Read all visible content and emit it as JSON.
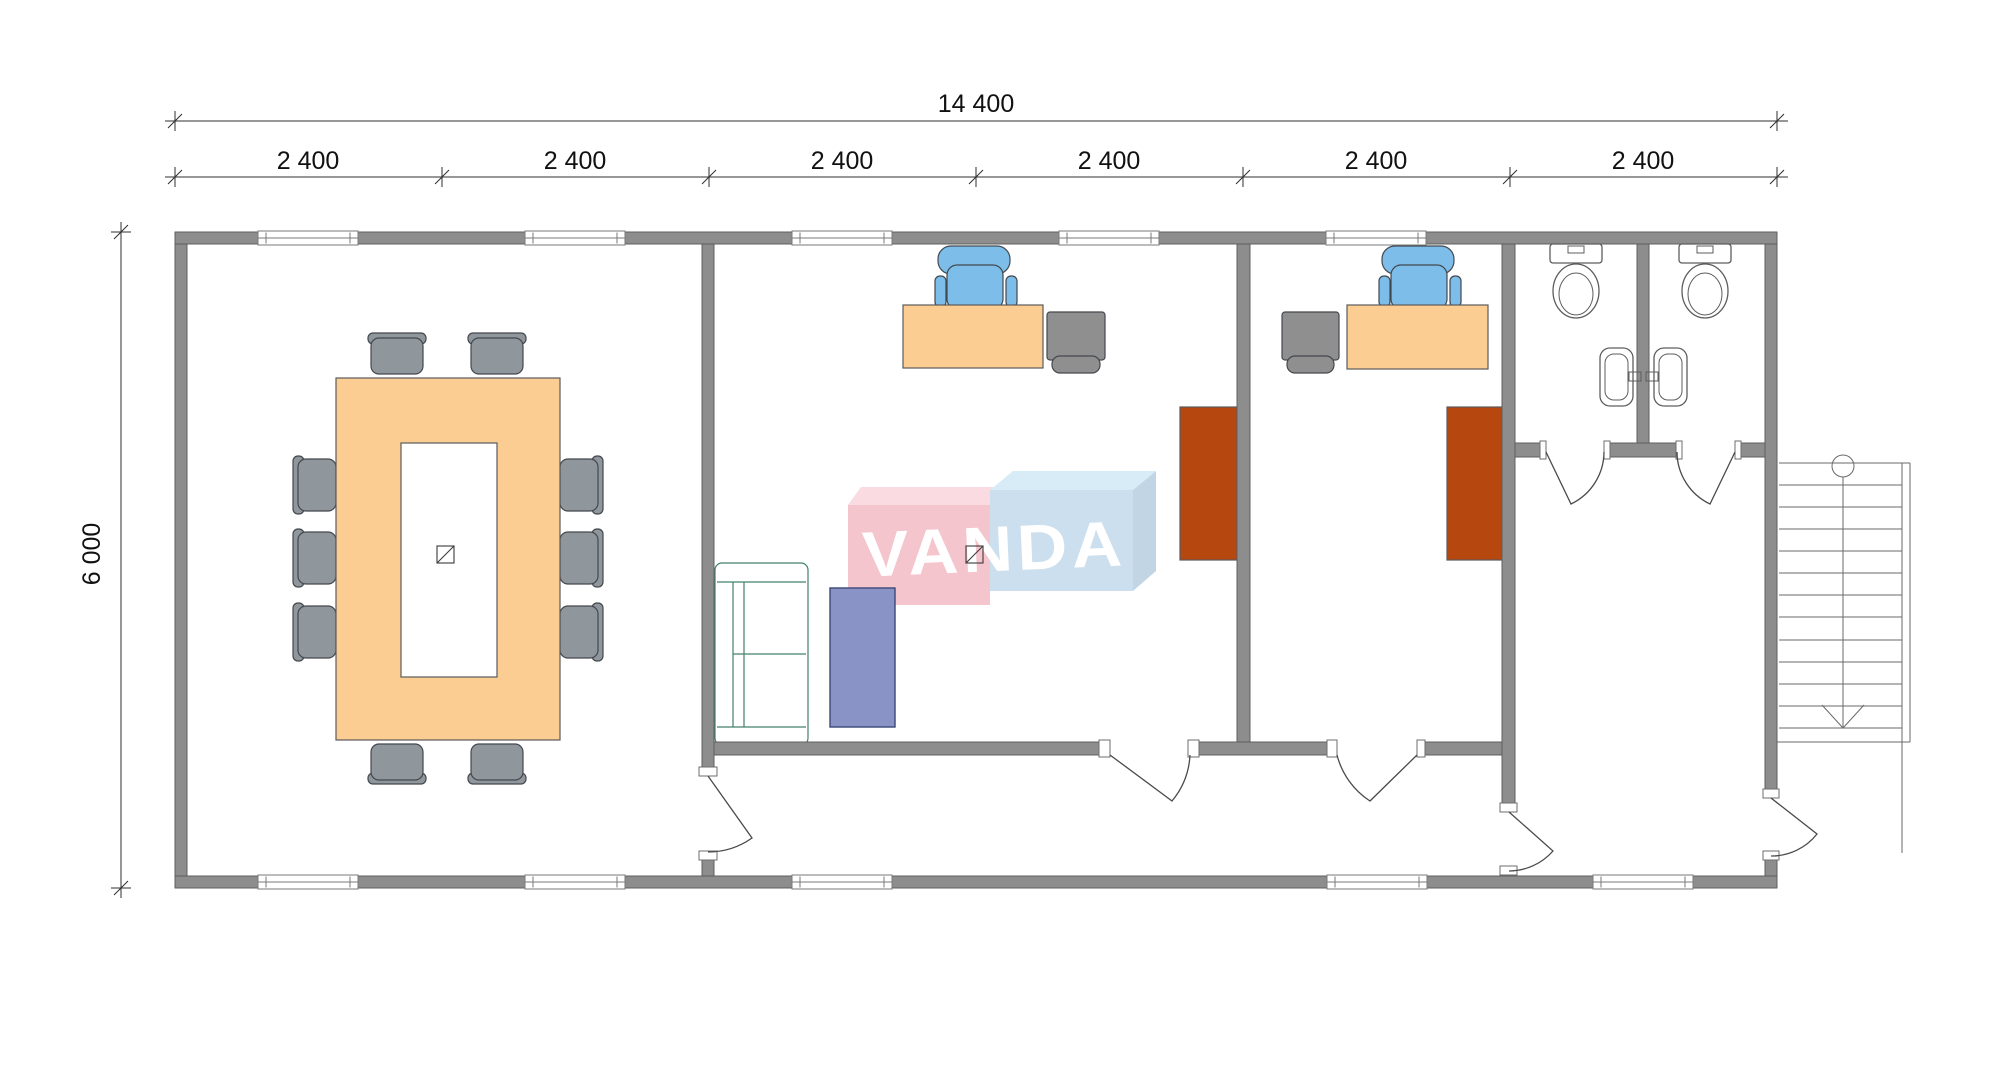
{
  "meta": {
    "drawing_type": "architectural floor plan, top view",
    "watermark": "VANDA"
  },
  "dimensions": {
    "top_total": {
      "label": "14 400"
    },
    "top_segments": {
      "labels": [
        "2 400",
        "2 400",
        "2 400",
        "2 400",
        "2 400",
        "2 400"
      ]
    },
    "left_height": {
      "label": "6 000"
    }
  },
  "building": {
    "overall_width_mm": 14400,
    "overall_depth_mm": 6000,
    "bay_width_mm": 2400,
    "bays": 6,
    "windows_top_wall": 5,
    "windows_bottom_wall": 5,
    "doors": 7
  },
  "rooms": [
    {
      "name": "conference-room",
      "furniture": [
        "conference-table",
        "chair x10",
        "column"
      ]
    },
    {
      "name": "office-1",
      "furniture": [
        "desk",
        "task-chair",
        "drawer-unit",
        "sofa",
        "coffee-table",
        "sideboard",
        "column"
      ]
    },
    {
      "name": "office-2",
      "furniture": [
        "desk",
        "task-chair",
        "drawer-unit",
        "sideboard"
      ]
    },
    {
      "name": "wc-1",
      "furniture": [
        "toilet",
        "washbasin"
      ]
    },
    {
      "name": "wc-2",
      "furniture": [
        "toilet",
        "washbasin"
      ]
    },
    {
      "name": "corridor",
      "furniture": []
    },
    {
      "name": "hallway",
      "furniture": []
    },
    {
      "name": "exterior-staircase",
      "steps": 13,
      "marker": "up-direction arrow with start circle"
    }
  ],
  "colors": {
    "wall": "#8d8d8d",
    "fixture": "#ffffff",
    "table": "#fbcd92",
    "chair": "#8f969c",
    "office_chair": "#7cbde9",
    "cabinet": "#8f8f8f",
    "sideboard": "#b5470f",
    "sofa": "#b4e6d5",
    "rug": "#8a93c6",
    "logo_pink_face": "#f5c5cd",
    "logo_pink_top": "#f9dbe1",
    "logo_blue_face": "#cbdfee",
    "logo_blue_top": "#d8ecf8",
    "logo_blue_side": "#c2d5e5",
    "logo_text": "#ffffff"
  }
}
